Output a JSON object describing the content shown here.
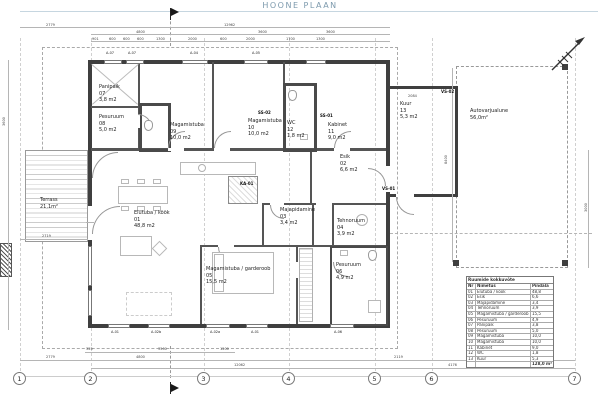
{
  "title": "HOONE PLAAN",
  "colors": {
    "accent_blue": "#7d9aad",
    "rule_blue": "#c6d6e0",
    "wall_dark": "#3f3f3f",
    "line_gray": "#9a9a9a"
  },
  "rooms": [
    {
      "name": "Panipaik",
      "nr": "07",
      "area": "3,8 m2",
      "x": 99,
      "y": 84
    },
    {
      "name": "Pesuruum",
      "nr": "08",
      "area": "5,0 m2",
      "x": 99,
      "y": 114
    },
    {
      "name": "Magamistuba",
      "nr": "09",
      "area": "10,0 m2",
      "x": 170,
      "y": 122
    },
    {
      "name": "Magamistuba",
      "nr": "10",
      "area": "10,0 m2",
      "x": 248,
      "y": 118
    },
    {
      "name": "WC",
      "nr": "12",
      "area": "1,8 m2",
      "x": 287,
      "y": 120
    },
    {
      "name": "Kabinet",
      "nr": "11",
      "area": "9,0 m2",
      "x": 328,
      "y": 122
    },
    {
      "name": "Esik",
      "nr": "02",
      "area": "6,6 m2",
      "x": 340,
      "y": 154
    },
    {
      "name": "Kuur",
      "nr": "13",
      "area": "5,3 m2",
      "x": 400,
      "y": 101
    },
    {
      "name": "Elutuba / köök",
      "nr": "01",
      "area": "48,8 m2",
      "x": 134,
      "y": 210
    },
    {
      "name": "Majapidamine",
      "nr": "03",
      "area": "3,4 m2",
      "x": 280,
      "y": 207
    },
    {
      "name": "Tehnoruum",
      "nr": "04",
      "area": "3,9 m2",
      "x": 337,
      "y": 218
    },
    {
      "name": "Magamistuba / garderoob",
      "nr": "05",
      "area": "15,5 m2",
      "x": 206,
      "y": 266
    },
    {
      "name": "Pesuruum",
      "nr": "06",
      "area": "4,9 m2",
      "x": 336,
      "y": 262
    },
    {
      "name": "Terrass",
      "nr": "",
      "area": "21,1m²",
      "x": 40,
      "y": 197
    },
    {
      "name": "Autovarjualune",
      "nr": "",
      "area": "56,0m²",
      "x": 470,
      "y": 108
    }
  ],
  "wall_tags": [
    {
      "t": "SS-02",
      "x": 258,
      "y": 110
    },
    {
      "t": "SS-01",
      "x": 320,
      "y": 113
    },
    {
      "t": "VS-01",
      "x": 382,
      "y": 186
    },
    {
      "t": "VS-02",
      "x": 441,
      "y": 89
    },
    {
      "t": "KA-01",
      "x": 240,
      "y": 181
    }
  ],
  "window_tags": [
    {
      "t": "A-07",
      "x": 106,
      "y": 51
    },
    {
      "t": "A-07",
      "x": 128,
      "y": 51
    },
    {
      "t": "A-04",
      "x": 190,
      "y": 51
    },
    {
      "t": "A-05",
      "x": 252,
      "y": 51
    },
    {
      "t": "A-01",
      "x": 111,
      "y": 330
    },
    {
      "t": "A-02b",
      "x": 151,
      "y": 330
    },
    {
      "t": "A-02a",
      "x": 210,
      "y": 330
    },
    {
      "t": "A-01",
      "x": 251,
      "y": 330
    },
    {
      "t": "A-06",
      "x": 334,
      "y": 330
    }
  ],
  "dims": [
    {
      "t": "2779",
      "x": 46,
      "y": 23
    },
    {
      "t": "12962",
      "x": 224,
      "y": 23
    },
    {
      "t": "4800",
      "x": 136,
      "y": 30
    },
    {
      "t": "3600",
      "x": 258,
      "y": 30
    },
    {
      "t": "3600",
      "x": 326,
      "y": 30
    },
    {
      "t": "901",
      "x": 92,
      "y": 37
    },
    {
      "t": "600",
      "x": 109,
      "y": 37
    },
    {
      "t": "600",
      "x": 123,
      "y": 37
    },
    {
      "t": "600",
      "x": 137,
      "y": 37
    },
    {
      "t": "1300",
      "x": 156,
      "y": 37
    },
    {
      "t": "2000",
      "x": 188,
      "y": 37
    },
    {
      "t": "600",
      "x": 220,
      "y": 37
    },
    {
      "t": "2000",
      "x": 246,
      "y": 37
    },
    {
      "t": "1700",
      "x": 286,
      "y": 37
    },
    {
      "t": "1300",
      "x": 316,
      "y": 37
    },
    {
      "t": "2084",
      "x": 408,
      "y": 94
    },
    {
      "t": "2719",
      "x": 42,
      "y": 234
    },
    {
      "t": "325",
      "x": 86,
      "y": 347
    },
    {
      "t": "3500",
      "x": 158,
      "y": 347
    },
    {
      "t": "1200",
      "x": 220,
      "y": 347
    },
    {
      "t": "2779",
      "x": 46,
      "y": 355
    },
    {
      "t": "4800",
      "x": 136,
      "y": 355
    },
    {
      "t": "2119",
      "x": 394,
      "y": 355
    },
    {
      "t": "6000",
      "x": 492,
      "y": 355
    },
    {
      "t": "12062",
      "x": 234,
      "y": 363
    },
    {
      "t": "4176",
      "x": 448,
      "y": 363
    },
    {
      "t": "3600",
      "x": 2,
      "y": 126,
      "r": -90
    },
    {
      "t": "8400",
      "x": 444,
      "y": 164,
      "r": -90
    },
    {
      "t": "3000",
      "x": 584,
      "y": 212,
      "r": -90
    }
  ],
  "grid_bubbles": [
    {
      "n": "1",
      "x": 13
    },
    {
      "n": "2",
      "x": 84
    },
    {
      "n": "3",
      "x": 197
    },
    {
      "n": "4",
      "x": 282
    },
    {
      "n": "5",
      "x": 368
    },
    {
      "n": "6",
      "x": 425
    },
    {
      "n": "7",
      "x": 568
    }
  ],
  "area_table": {
    "title": "Ruumide kokkuvõte",
    "headers": {
      "nr": "Nr",
      "name": "Nimetus",
      "area": "Pindala"
    },
    "rows": [
      {
        "nr": "01",
        "name": "Elutuba / köök",
        "area": "48,8"
      },
      {
        "nr": "02",
        "name": "Esik",
        "area": "6,6"
      },
      {
        "nr": "03",
        "name": "Majapidamine",
        "area": "3,4"
      },
      {
        "nr": "04",
        "name": "Tehnoruum",
        "area": "3,9"
      },
      {
        "nr": "05",
        "name": "Magamistuba / garderoob",
        "area": "15,5"
      },
      {
        "nr": "06",
        "name": "Pesuruum",
        "area": "4,9"
      },
      {
        "nr": "07",
        "name": "Panipaik",
        "area": "3,8"
      },
      {
        "nr": "08",
        "name": "Pesuruum",
        "area": "5,0"
      },
      {
        "nr": "09",
        "name": "Magamistuba",
        "area": "10,0"
      },
      {
        "nr": "10",
        "name": "Magamistuba",
        "area": "10,0"
      },
      {
        "nr": "11",
        "name": "Kabinet",
        "area": "9,0"
      },
      {
        "nr": "12",
        "name": "WC",
        "area": "1,8"
      },
      {
        "nr": "13",
        "name": "Kuur",
        "area": "5,3"
      }
    ],
    "total": "128,0 m²"
  }
}
